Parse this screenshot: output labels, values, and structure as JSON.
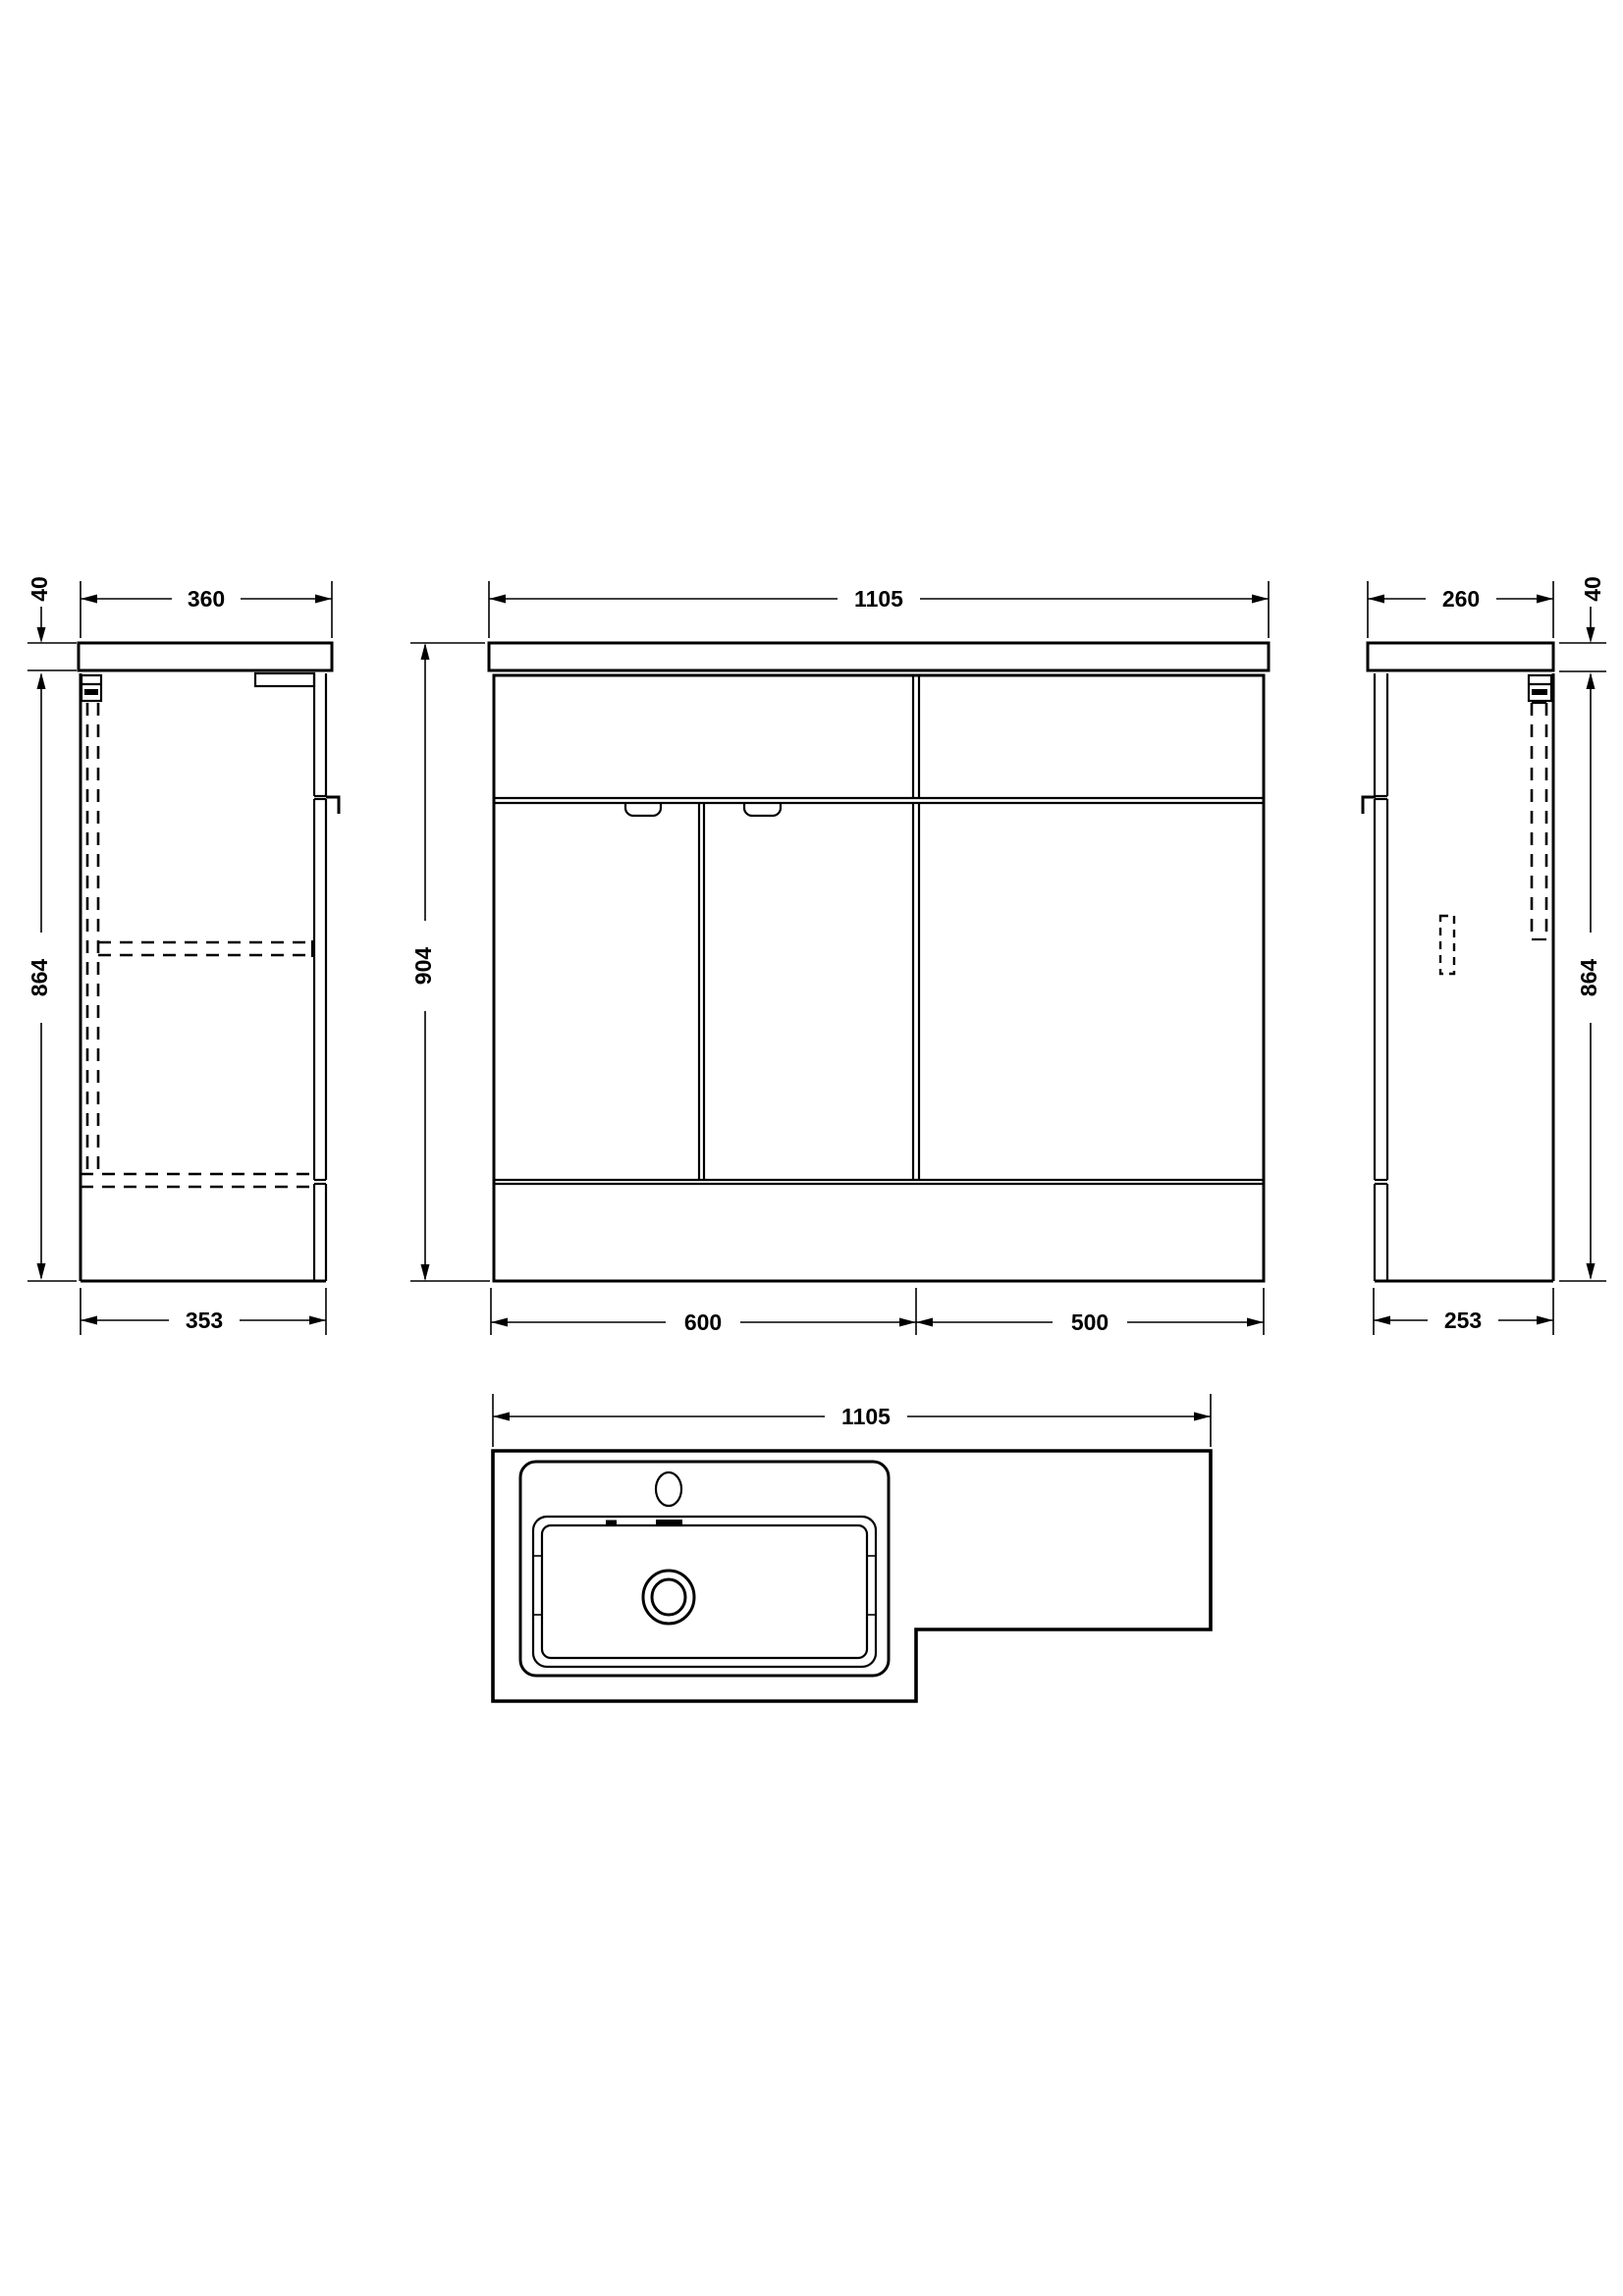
{
  "views": {
    "left_side": {
      "counter_thickness": "40",
      "top_width": "360",
      "height": "864",
      "bottom_width": "353"
    },
    "front": {
      "overall_width": "1105",
      "height": "904",
      "left_section": "600",
      "right_section": "500"
    },
    "right_side": {
      "top_width": "260",
      "counter_thickness": "40",
      "height": "864",
      "bottom_width": "253"
    },
    "plan": {
      "overall_width": "1105"
    }
  },
  "colors": {
    "line": "#000000",
    "background": "#ffffff"
  }
}
